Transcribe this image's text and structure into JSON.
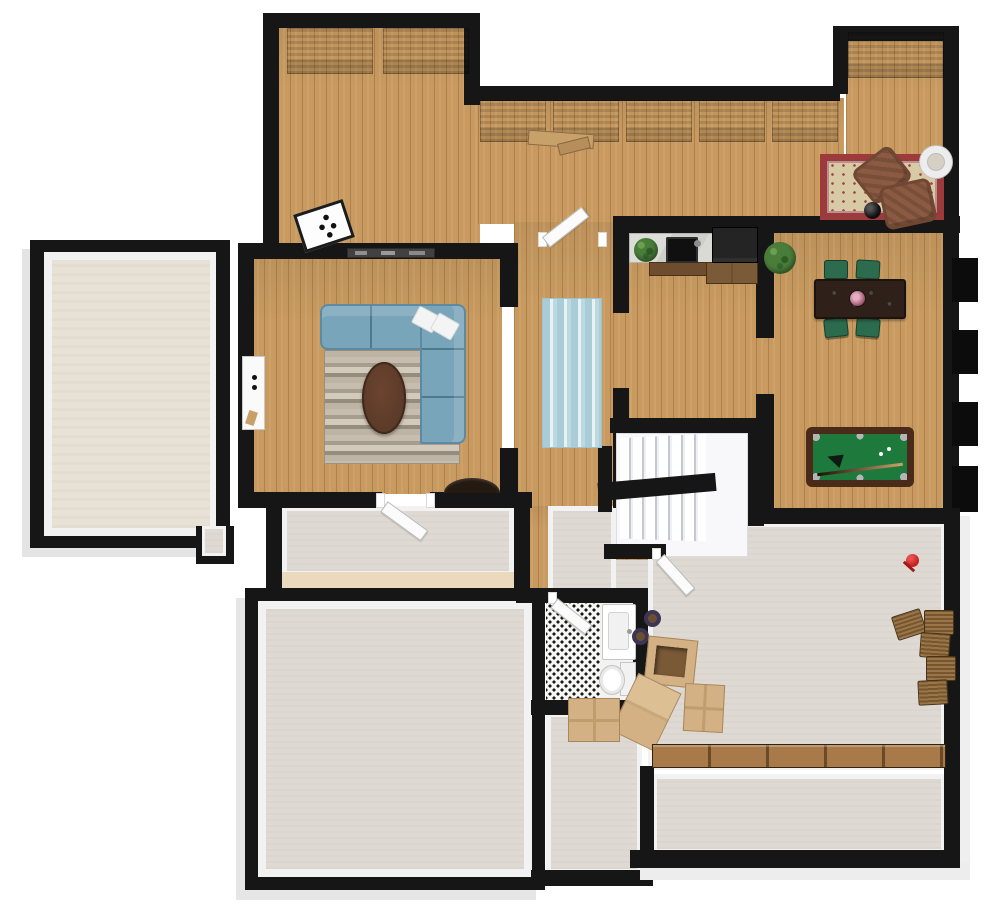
{
  "scene": {
    "type": "3d-floor-plan-top-down-view",
    "background": "#ffffff",
    "floor_types": [
      "hardwood",
      "carpet",
      "concrete",
      "patterned-tile"
    ]
  },
  "colors": {
    "wall": "#161616",
    "wall_trim": "#f2f2f2",
    "wood_floor": "#c89a5f",
    "carpet_floor": "#e7e1d6",
    "concrete_floor": "#dedad3",
    "door_white": "#fbfbfb",
    "sofa_blue": "#79a5ba",
    "rug_runner_blue": "#a9ccd6",
    "oriental_rug_red": "#9c3a3c",
    "oriental_rug_cream": "#d9caa6",
    "armchair_brown": "#8a5a42",
    "pool_felt_green": "#1e7a3c",
    "pool_frame_brown": "#4a2a18",
    "dining_chair_green": "#2c6b4e",
    "dining_table_brown": "#2f211a",
    "cardboard_tan": "#d3b184",
    "basket_brown": "#8a673e",
    "bench_wood": "#a87a4a",
    "shelf_wood_top": "#d9b87f",
    "shelf_wood_body": "#7d6344",
    "plant_green": "#4a7d3a",
    "coffee_table_brown": "#5b3a28",
    "bathroom_tile_dot": "#1a1a1a",
    "toy_red": "#c52222",
    "counter_marble": "#d9d9d5",
    "appliance_dark": "#242424"
  },
  "rooms": [
    {
      "id": "top-left-room",
      "floor": "hardwood",
      "items": [
        "wall-shelf",
        "wall-shelf",
        "game-board"
      ]
    },
    {
      "id": "top-middle-room",
      "floor": "hardwood",
      "items": [
        "wall-shelf",
        "wall-shelf",
        "wall-shelf",
        "wall-shelf",
        "wall-shelf",
        "small-wood-bench"
      ]
    },
    {
      "id": "sitting-nook",
      "floor": "hardwood",
      "items": [
        "wall-shelf",
        "oriental-rug",
        "brown-armchair",
        "brown-armchair",
        "floor-lamp",
        "round-mirror"
      ]
    },
    {
      "id": "left-storage-room",
      "floor": "carpet",
      "items": []
    },
    {
      "id": "living-room",
      "floor": "hardwood",
      "items": [
        "sectional-sofa",
        "striped-rug",
        "oval-coffee-table",
        "throw-pillow",
        "throw-pillow",
        "media-console",
        "white-wall-cabinet"
      ]
    },
    {
      "id": "hallway",
      "floor": "hardwood",
      "items": [
        "blue-runner-rug"
      ]
    },
    {
      "id": "kitchen",
      "floor": "hardwood",
      "items": [
        "marble-counter",
        "sink",
        "counter-plant",
        "refrigerator",
        "wood-cabinets"
      ]
    },
    {
      "id": "dining-room",
      "floor": "hardwood",
      "items": [
        "dining-table",
        "green-chair",
        "green-chair",
        "green-chair",
        "green-chair",
        "flower-centerpiece",
        "potted-plant",
        "pool-table"
      ]
    },
    {
      "id": "staircase",
      "floor": "hardwood",
      "items": [
        "u-shaped-stairs"
      ]
    },
    {
      "id": "mudroom",
      "floor": "concrete",
      "items": [
        "half-round-console"
      ]
    },
    {
      "id": "bottom-left-room",
      "floor": "concrete",
      "items": []
    },
    {
      "id": "bathroom",
      "floor": "patterned-tile",
      "items": [
        "vanity-sink",
        "toilet"
      ]
    },
    {
      "id": "recreation-room",
      "floor": "concrete",
      "items": [
        "cardboard-box",
        "cardboard-box",
        "cardboard-box",
        "cardboard-box",
        "wicker-basket",
        "wicker-basket",
        "wicker-basket",
        "wicker-basket",
        "wicker-basket",
        "floor-pouf",
        "floor-pouf",
        "red-toy",
        "long-wood-bench"
      ]
    },
    {
      "id": "bottom-strip-room",
      "floor": "concrete",
      "items": []
    }
  ]
}
